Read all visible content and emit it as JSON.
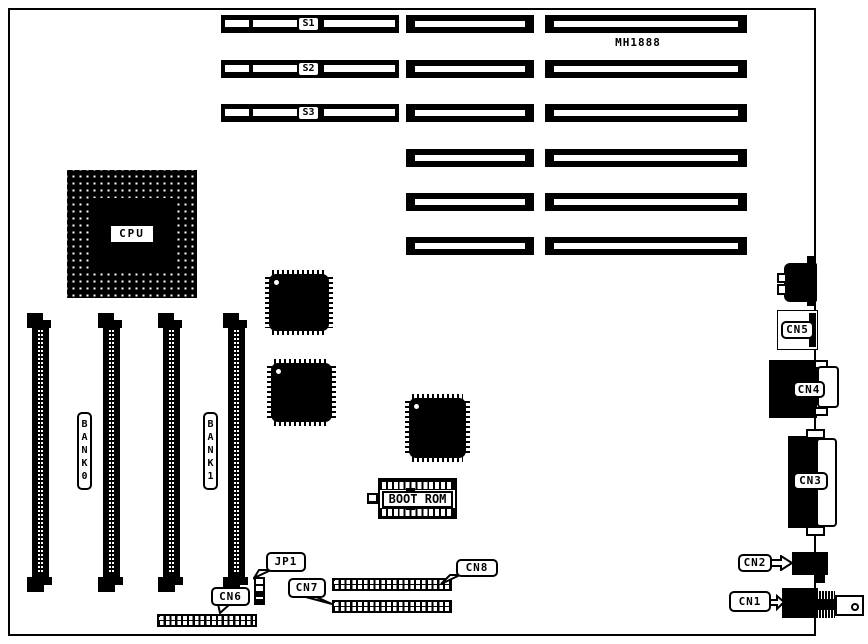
{
  "board": {
    "model": "MH1888"
  },
  "expansion_slots": {
    "labels": [
      "S1",
      "S2",
      "S3"
    ]
  },
  "cpu": {
    "label": "CPU"
  },
  "memory": {
    "bank_labels": [
      "BANK0",
      "BANK1"
    ]
  },
  "boot_rom": {
    "label": "BOOT ROM"
  },
  "jumpers": {
    "jp1": "JP1"
  },
  "connectors": {
    "cn1": "CN1",
    "cn2": "CN2",
    "cn3": "CN3",
    "cn4": "CN4",
    "cn5": "CN5",
    "cn6": "CN6",
    "cn7": "CN7",
    "cn8": "CN8"
  },
  "colors": {
    "ink": "#000000",
    "background": "#ffffff"
  }
}
